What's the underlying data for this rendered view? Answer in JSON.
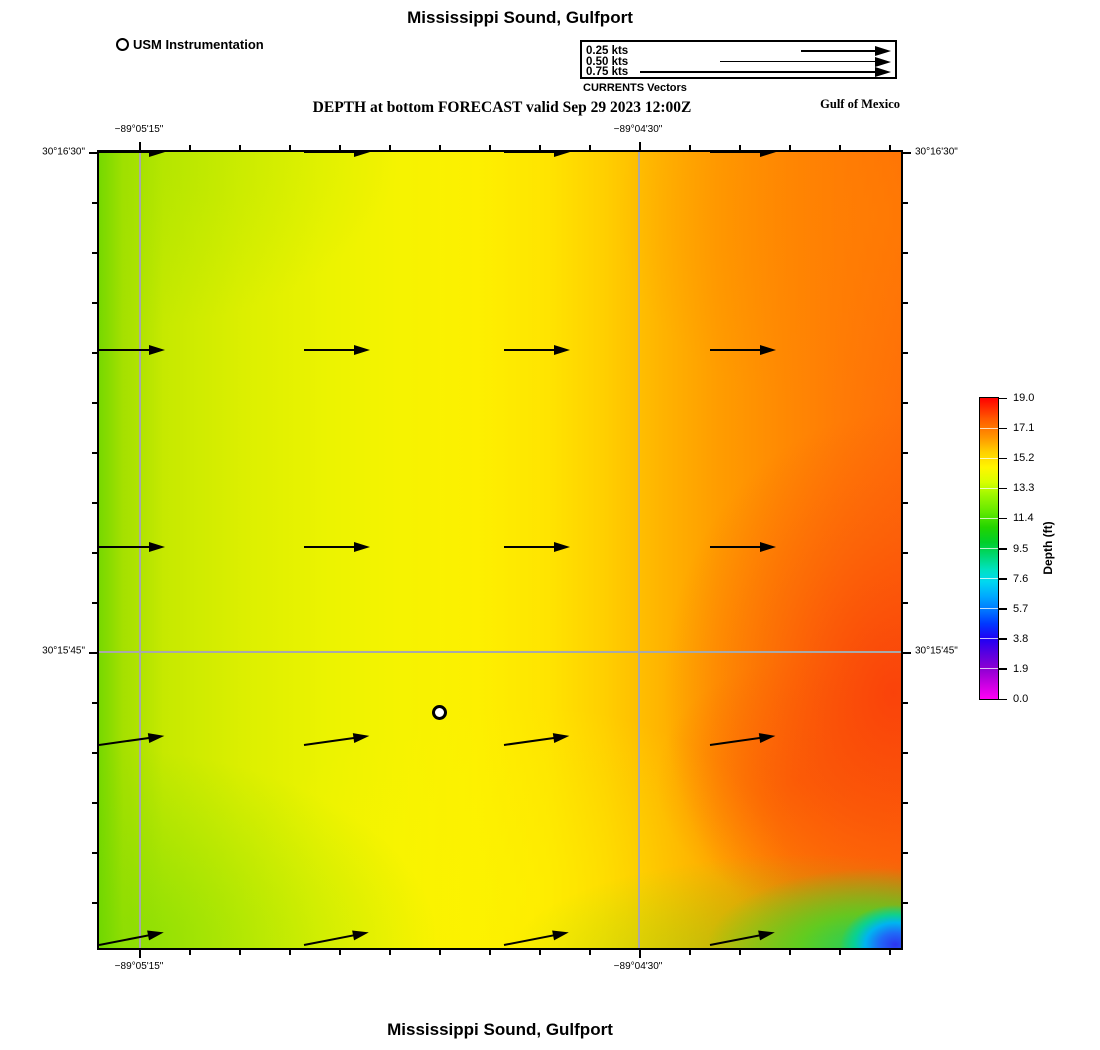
{
  "title_top": "Mississippi Sound, Gulfport",
  "title_bottom": "Mississippi Sound, Gulfport",
  "subtitle": "DEPTH at bottom FORECAST valid Sep 29 2023 12:00Z",
  "region_label": "Gulf of Mexico",
  "station_legend": {
    "label": "USM Instrumentation"
  },
  "vector_legend": {
    "caption": "CURRENTS Vectors",
    "items": [
      {
        "label": "0.25 kts",
        "length_px": 90
      },
      {
        "label": "0.50 kts",
        "length_px": 171
      },
      {
        "label": "0.75 kts",
        "length_px": 251
      }
    ]
  },
  "axes": {
    "x_ticks": [
      {
        "label": "−89°05'15\"",
        "px": 40
      },
      {
        "label": "−89°04'30\"",
        "px": 539
      }
    ],
    "y_ticks": [
      {
        "label": "30°16'30\"",
        "px": 0
      },
      {
        "label": "30°15'45\"",
        "px": 499
      }
    ]
  },
  "colorbar": {
    "label": "Depth (ft)",
    "ticks": [
      "19.0",
      "17.1",
      "15.2",
      "13.3",
      "11.4",
      "9.5",
      "7.6",
      "5.7",
      "3.8",
      "1.9",
      "0.0"
    ],
    "min": 0.0,
    "max": 19.0
  },
  "chart_data": {
    "type": "heatmap",
    "title": "Mississippi Sound, Gulfport",
    "subtitle": "DEPTH at bottom FORECAST valid Sep 29 2023 12:00Z",
    "variable": "Depth (ft)",
    "valid_time": "Sep 29 2023 12:00Z",
    "region_label": "Gulf of Mexico",
    "colorbar_range": [
      0.0,
      19.0
    ],
    "colorbar_ticks": [
      19.0,
      17.1,
      15.2,
      13.3,
      11.4,
      9.5,
      7.6,
      5.7,
      3.8,
      1.9,
      0.0
    ],
    "x_axis": {
      "type": "longitude",
      "tick_labels": [
        "−89°05'15\"",
        "−89°04'30\""
      ]
    },
    "y_axis": {
      "type": "latitude",
      "tick_labels": [
        "30°16'30\"",
        "30°15'45\""
      ]
    },
    "field_summary": {
      "west_edge_depth_ft": 13.5,
      "center_depth_ft": 15.2,
      "east_edge_depth_ft": 18.5,
      "southeast_corner_min_depth_ft": 3.5,
      "gradient": "depth increases from west (yellow-green ~13-14 ft) to east (orange-red ~18-19 ft); shallow blue/cyan/green patch in far southeast corner"
    },
    "vector_field": {
      "units": "kts",
      "approx_speed_kts": 0.25,
      "direction": "eastward, tilting slightly northeastward toward the south",
      "rows": [
        {
          "y": 0,
          "angle_deg": 0
        },
        {
          "y": 198,
          "angle_deg": 0
        },
        {
          "y": 395,
          "angle_deg": 0
        },
        {
          "y": 593,
          "angle_deg": -8
        },
        {
          "y": 793,
          "angle_deg": -11
        }
      ],
      "cols_x": [
        0,
        205,
        405,
        611
      ],
      "arrow_length_px": 66
    },
    "station": {
      "label": "USM Instrumentation",
      "x_px": 340,
      "y_px": 560
    }
  }
}
